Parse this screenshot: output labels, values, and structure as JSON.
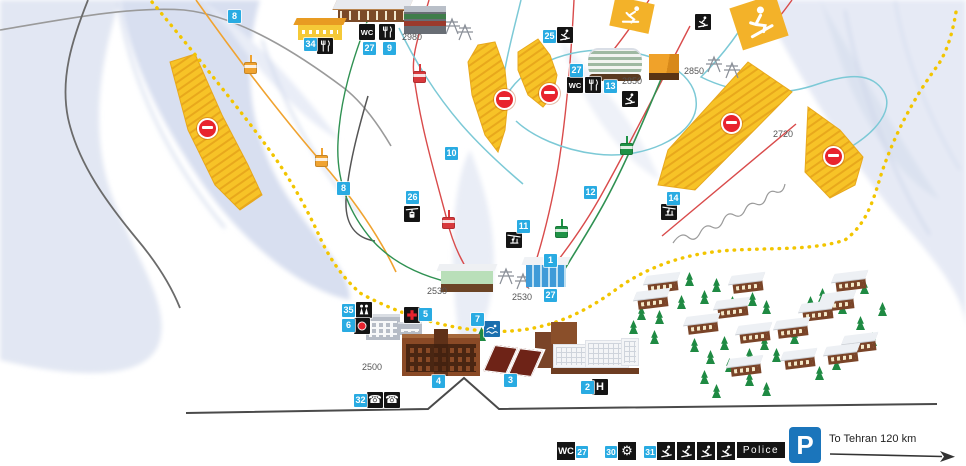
{
  "legend": {
    "wc": "WC",
    "wc_num": "27",
    "service_num": "30",
    "school_num": "31",
    "police": "Police",
    "parking": "P",
    "destination": "To Tehran 120 km"
  },
  "map": {
    "colors": {
      "marker_blue": "#29abe2",
      "icon_black": "#141414",
      "closed_area_yellow": "#f7c327",
      "no_entry_red": "#e8232e",
      "boundary_yellow": "#f2c500",
      "parking_blue": "#1b75bb"
    },
    "markers": [
      {
        "n": "8",
        "x": 228,
        "y": 10
      },
      {
        "n": "34",
        "x": 304,
        "y": 38
      },
      {
        "n": "27",
        "x": 363,
        "y": 42
      },
      {
        "n": "9",
        "x": 383,
        "y": 42
      },
      {
        "n": "25",
        "x": 543,
        "y": 30
      },
      {
        "n": "27",
        "x": 570,
        "y": 64
      },
      {
        "n": "13",
        "x": 604,
        "y": 80
      },
      {
        "n": "10",
        "x": 445,
        "y": 147
      },
      {
        "n": "8",
        "x": 337,
        "y": 182
      },
      {
        "n": "26",
        "x": 406,
        "y": 191
      },
      {
        "n": "12",
        "x": 584,
        "y": 186
      },
      {
        "n": "11",
        "x": 517,
        "y": 220
      },
      {
        "n": "14",
        "x": 667,
        "y": 192
      },
      {
        "n": "1",
        "x": 544,
        "y": 254
      },
      {
        "n": "27",
        "x": 544,
        "y": 289
      },
      {
        "n": "35",
        "x": 342,
        "y": 304
      },
      {
        "n": "6",
        "x": 342,
        "y": 319
      },
      {
        "n": "5",
        "x": 419,
        "y": 308
      },
      {
        "n": "7",
        "x": 471,
        "y": 313
      },
      {
        "n": "4",
        "x": 432,
        "y": 375
      },
      {
        "n": "3",
        "x": 504,
        "y": 374
      },
      {
        "n": "2",
        "x": 581,
        "y": 381
      },
      {
        "n": "32",
        "x": 354,
        "y": 394
      }
    ],
    "icons": [
      {
        "kind": "wc",
        "text": "WC",
        "x": 359,
        "y": 24
      },
      {
        "kind": "restaurant",
        "x": 379,
        "y": 24
      },
      {
        "kind": "restaurant",
        "x": 317,
        "y": 38
      },
      {
        "kind": "skier",
        "x": 557,
        "y": 27
      },
      {
        "kind": "wc",
        "text": "WC",
        "x": 567,
        "y": 77
      },
      {
        "kind": "restaurant",
        "x": 585,
        "y": 77
      },
      {
        "kind": "skier",
        "x": 622,
        "y": 91
      },
      {
        "kind": "skier",
        "x": 695,
        "y": 14
      },
      {
        "kind": "gondola",
        "x": 404,
        "y": 206
      },
      {
        "kind": "chairlift",
        "x": 506,
        "y": 232
      },
      {
        "kind": "chairlift",
        "x": 661,
        "y": 204
      },
      {
        "kind": "family",
        "x": 356,
        "y": 302
      },
      {
        "kind": "reddot",
        "x": 354,
        "y": 318
      },
      {
        "kind": "aid",
        "x": 404,
        "y": 307
      },
      {
        "kind": "pool",
        "x": 484,
        "y": 321
      },
      {
        "kind": "phone",
        "text": "☎",
        "x": 367,
        "y": 392
      },
      {
        "kind": "phone",
        "text": "☎",
        "x": 384,
        "y": 392
      },
      {
        "kind": "hotel",
        "text": "H",
        "x": 592,
        "y": 379
      }
    ],
    "elevations": [
      {
        "t": "2980",
        "x": 402,
        "y": 32
      },
      {
        "t": "2850",
        "x": 622,
        "y": 76
      },
      {
        "t": "2850",
        "x": 684,
        "y": 66
      },
      {
        "t": "2720",
        "x": 773,
        "y": 129
      },
      {
        "t": "2530",
        "x": 427,
        "y": 286
      },
      {
        "t": "2530",
        "x": 512,
        "y": 292
      },
      {
        "t": "2500",
        "x": 362,
        "y": 362
      }
    ],
    "no_entry_signs": [
      {
        "x": 197,
        "y": 118
      },
      {
        "x": 494,
        "y": 89
      },
      {
        "x": 539,
        "y": 83
      },
      {
        "x": 721,
        "y": 113
      },
      {
        "x": 823,
        "y": 146
      }
    ],
    "cabins": [
      {
        "c": "orange",
        "x": 243,
        "y": 55
      },
      {
        "c": "orange",
        "x": 314,
        "y": 148
      },
      {
        "c": "red",
        "x": 412,
        "y": 64
      },
      {
        "c": "red",
        "x": 441,
        "y": 210
      },
      {
        "c": "green",
        "x": 619,
        "y": 136
      },
      {
        "c": "green",
        "x": 554,
        "y": 219
      }
    ],
    "towers": [
      {
        "x": 442,
        "y": 16
      },
      {
        "x": 455,
        "y": 22
      },
      {
        "x": 704,
        "y": 54
      },
      {
        "x": 722,
        "y": 60
      },
      {
        "x": 496,
        "y": 266
      },
      {
        "x": 513,
        "y": 271
      }
    ],
    "houses": [
      {
        "x": 648,
        "y": 282
      },
      {
        "x": 638,
        "y": 298
      },
      {
        "x": 733,
        "y": 282
      },
      {
        "x": 836,
        "y": 280
      },
      {
        "x": 824,
        "y": 300
      },
      {
        "x": 718,
        "y": 307
      },
      {
        "x": 803,
        "y": 310
      },
      {
        "x": 688,
        "y": 323
      },
      {
        "x": 740,
        "y": 332
      },
      {
        "x": 778,
        "y": 327
      },
      {
        "x": 846,
        "y": 342
      },
      {
        "x": 828,
        "y": 353
      },
      {
        "x": 731,
        "y": 365
      },
      {
        "x": 785,
        "y": 358
      }
    ],
    "trees": [
      {
        "x": 662,
        "y": 276
      },
      {
        "x": 700,
        "y": 290
      },
      {
        "x": 712,
        "y": 278
      },
      {
        "x": 677,
        "y": 295
      },
      {
        "x": 655,
        "y": 310
      },
      {
        "x": 728,
        "y": 296
      },
      {
        "x": 748,
        "y": 292
      },
      {
        "x": 762,
        "y": 300
      },
      {
        "x": 690,
        "y": 338
      },
      {
        "x": 706,
        "y": 350
      },
      {
        "x": 720,
        "y": 336
      },
      {
        "x": 745,
        "y": 348
      },
      {
        "x": 760,
        "y": 336
      },
      {
        "x": 772,
        "y": 348
      },
      {
        "x": 790,
        "y": 330
      },
      {
        "x": 806,
        "y": 296
      },
      {
        "x": 818,
        "y": 288
      },
      {
        "x": 838,
        "y": 300
      },
      {
        "x": 856,
        "y": 316
      },
      {
        "x": 800,
        "y": 352
      },
      {
        "x": 815,
        "y": 366
      },
      {
        "x": 832,
        "y": 356
      },
      {
        "x": 700,
        "y": 370
      },
      {
        "x": 745,
        "y": 372
      },
      {
        "x": 762,
        "y": 382
      },
      {
        "x": 725,
        "y": 358
      },
      {
        "x": 650,
        "y": 330
      },
      {
        "x": 868,
        "y": 332
      },
      {
        "x": 878,
        "y": 302
      },
      {
        "x": 860,
        "y": 280
      },
      {
        "x": 712,
        "y": 384
      },
      {
        "x": 637,
        "y": 306
      },
      {
        "x": 629,
        "y": 320
      },
      {
        "x": 477,
        "y": 327
      },
      {
        "x": 467,
        "y": 343
      },
      {
        "x": 685,
        "y": 272
      }
    ]
  }
}
